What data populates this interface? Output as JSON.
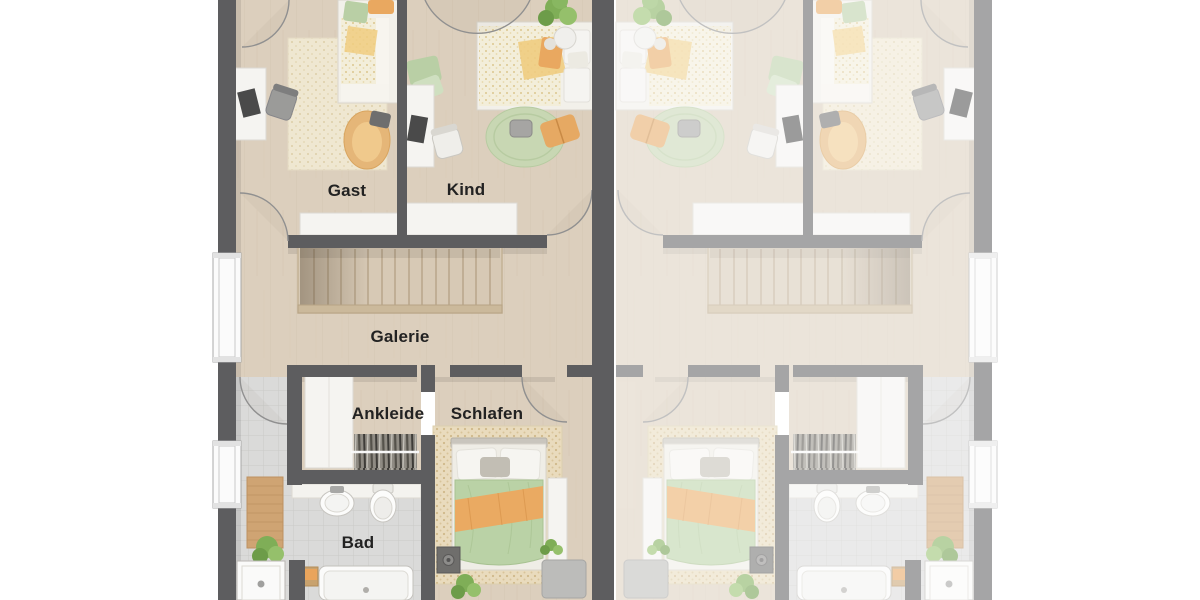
{
  "floor_plan": {
    "type": "top-down 3D floor plan, semi-detached house (two mirrored units)",
    "right_unit": {
      "mirrored": true,
      "opacity": 0.55,
      "labels_visible": false
    },
    "rooms": [
      {
        "id": "gast",
        "label": "Gast"
      },
      {
        "id": "kind",
        "label": "Kind"
      },
      {
        "id": "galerie",
        "label": "Galerie"
      },
      {
        "id": "ankleide",
        "label": "Ankleide"
      },
      {
        "id": "schlafen",
        "label": "Schlafen"
      },
      {
        "id": "bad",
        "label": "Bad"
      }
    ],
    "colors": {
      "wall": "#5d5d5f",
      "label": "#222222",
      "floor_wood": "#dccfbd",
      "floor_wood_line": "#ccbda6",
      "tile": "#dadad9",
      "tile_line": "#cacac8",
      "white_furniture": "#f5f4f1",
      "stair_frame": "#c3b295",
      "railing": "#cbb99b",
      "rug_cream": "#efe7d1",
      "rug_tan": "#e9dbbd",
      "rug_round_green": "#c8d7b3",
      "accent_orange": "#e9a860",
      "accent_yellow": "#f0cc80",
      "accent_green": "#bad2a6",
      "plant_green": "#7fae57",
      "bath_mat_wood": "#cfa473"
    }
  }
}
